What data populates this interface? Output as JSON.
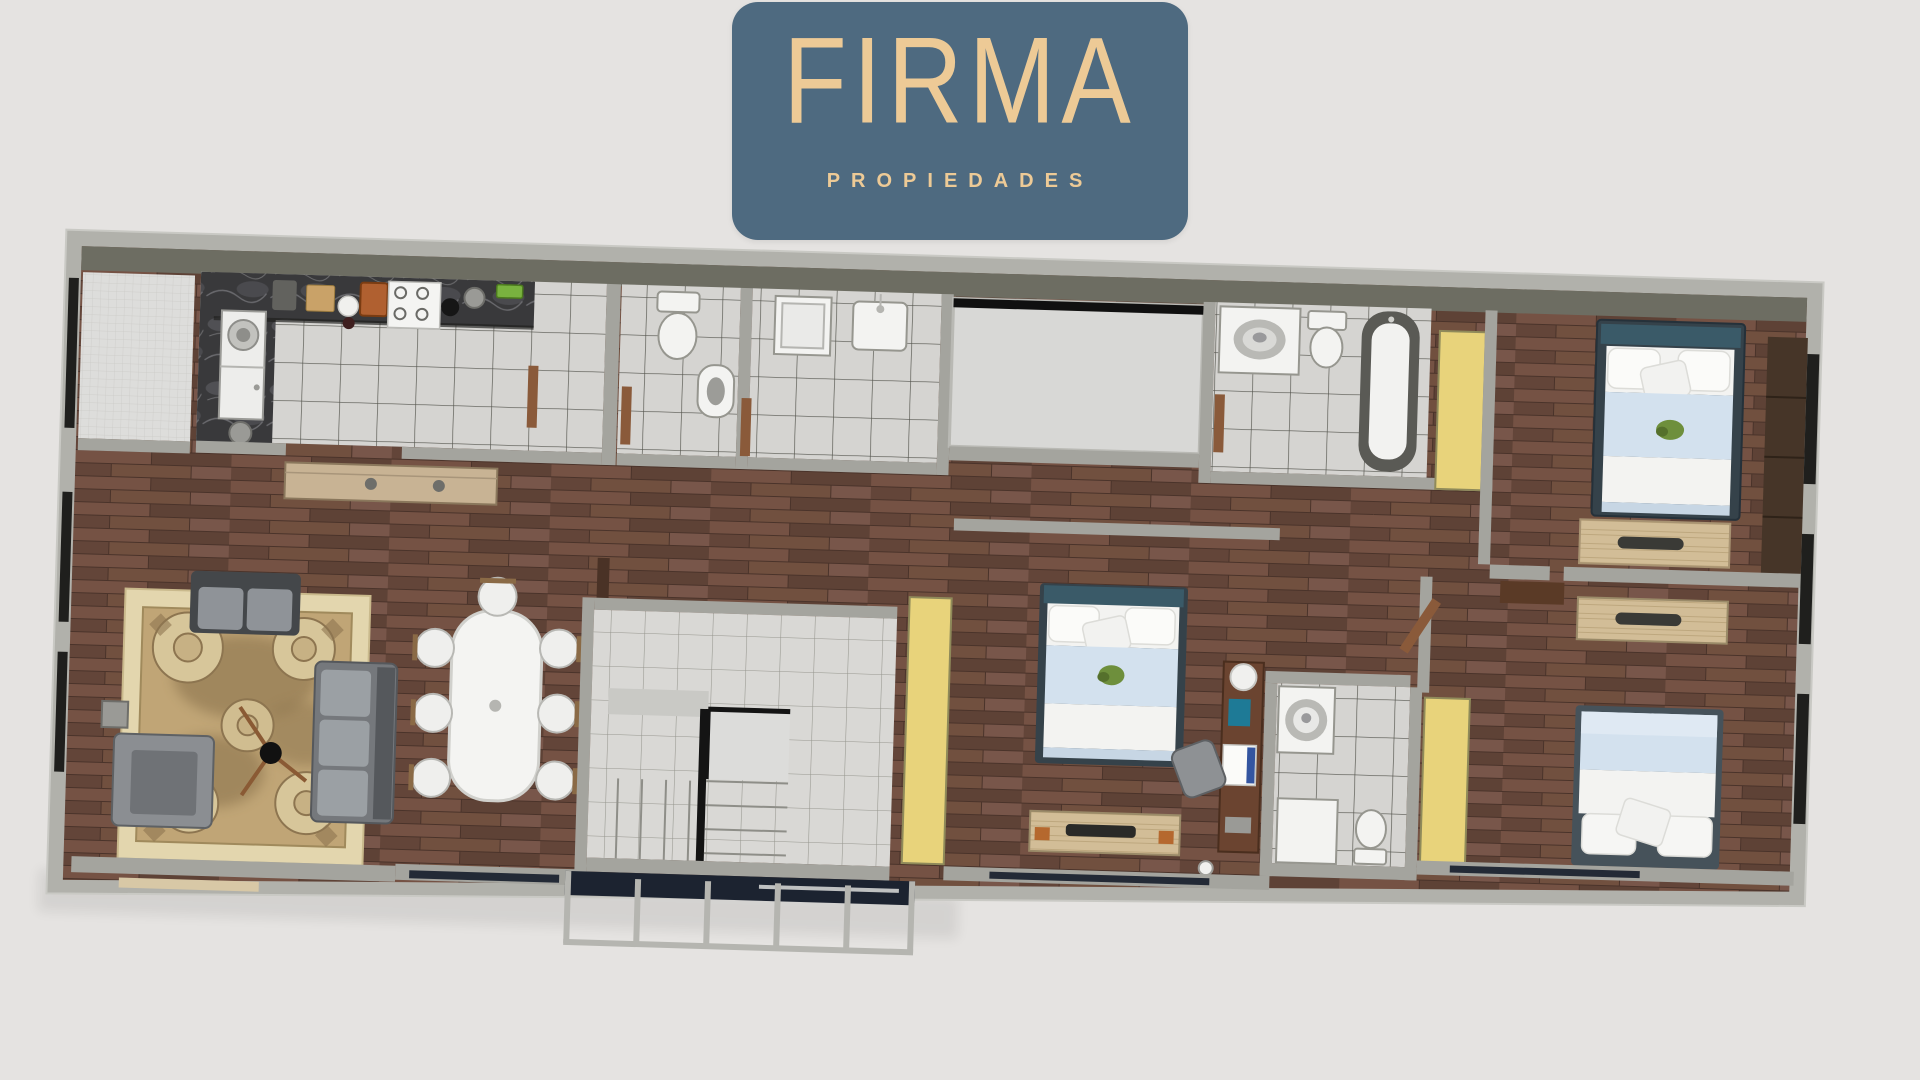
{
  "page": {
    "background": "#e5e3e1"
  },
  "brand": {
    "name": "FIRMA",
    "tagline": "PROPIEDADES",
    "badge_color": "#4e6a80",
    "text_color": "#edca96"
  },
  "palette": {
    "wall": "#b1b1ab",
    "wall_inner_band": "#6d6d62",
    "wood_floor": "#6a4a3c",
    "wood_light": "#d2bd97",
    "tile": "#d5d4d1",
    "tile_light": "#d9d8d5",
    "fine_tile": "#dddddb",
    "yellow_door": "#e8d37b",
    "rug_border": "#e3d6ae",
    "rug_field": "#c0a576",
    "bedding_blue": "#d3e1ee",
    "headboard_teal": "#3a5a68",
    "sofa_gray": "#75787c",
    "patio": "#d8d8d6",
    "counter_marble": "#39393b",
    "window_glass": "#1f1f1d",
    "bay_glass": "#1c2330",
    "navy_window": "#232a36",
    "door_brown": "#8a5a3a",
    "sideboard": "#c8b394"
  },
  "floor_plan": {
    "type": "apartment-top-view-3d-render",
    "rooms": [
      "utility-balcony",
      "kitchen",
      "bathroom-1",
      "bathroom-2",
      "patio-lightwell",
      "bathroom-3",
      "bedroom-1",
      "hallway",
      "living-room",
      "dining-room",
      "stairwell",
      "bedroom-2",
      "bathroom-4",
      "bedroom-3"
    ],
    "furniture": [
      "kitchen-counter",
      "fridge",
      "stove",
      "kitchen-sink",
      "toilet",
      "bidet",
      "shower-tray",
      "washbasin",
      "bathtub",
      "wardrobe",
      "double-bed",
      "console-table",
      "desk",
      "desk-chair",
      "sofa",
      "loveseat",
      "armchair",
      "floor-lamp",
      "side-table",
      "area-rug",
      "dining-table",
      "dining-chair",
      "sideboard",
      "staircase",
      "bay-window",
      "yellow-door"
    ]
  }
}
